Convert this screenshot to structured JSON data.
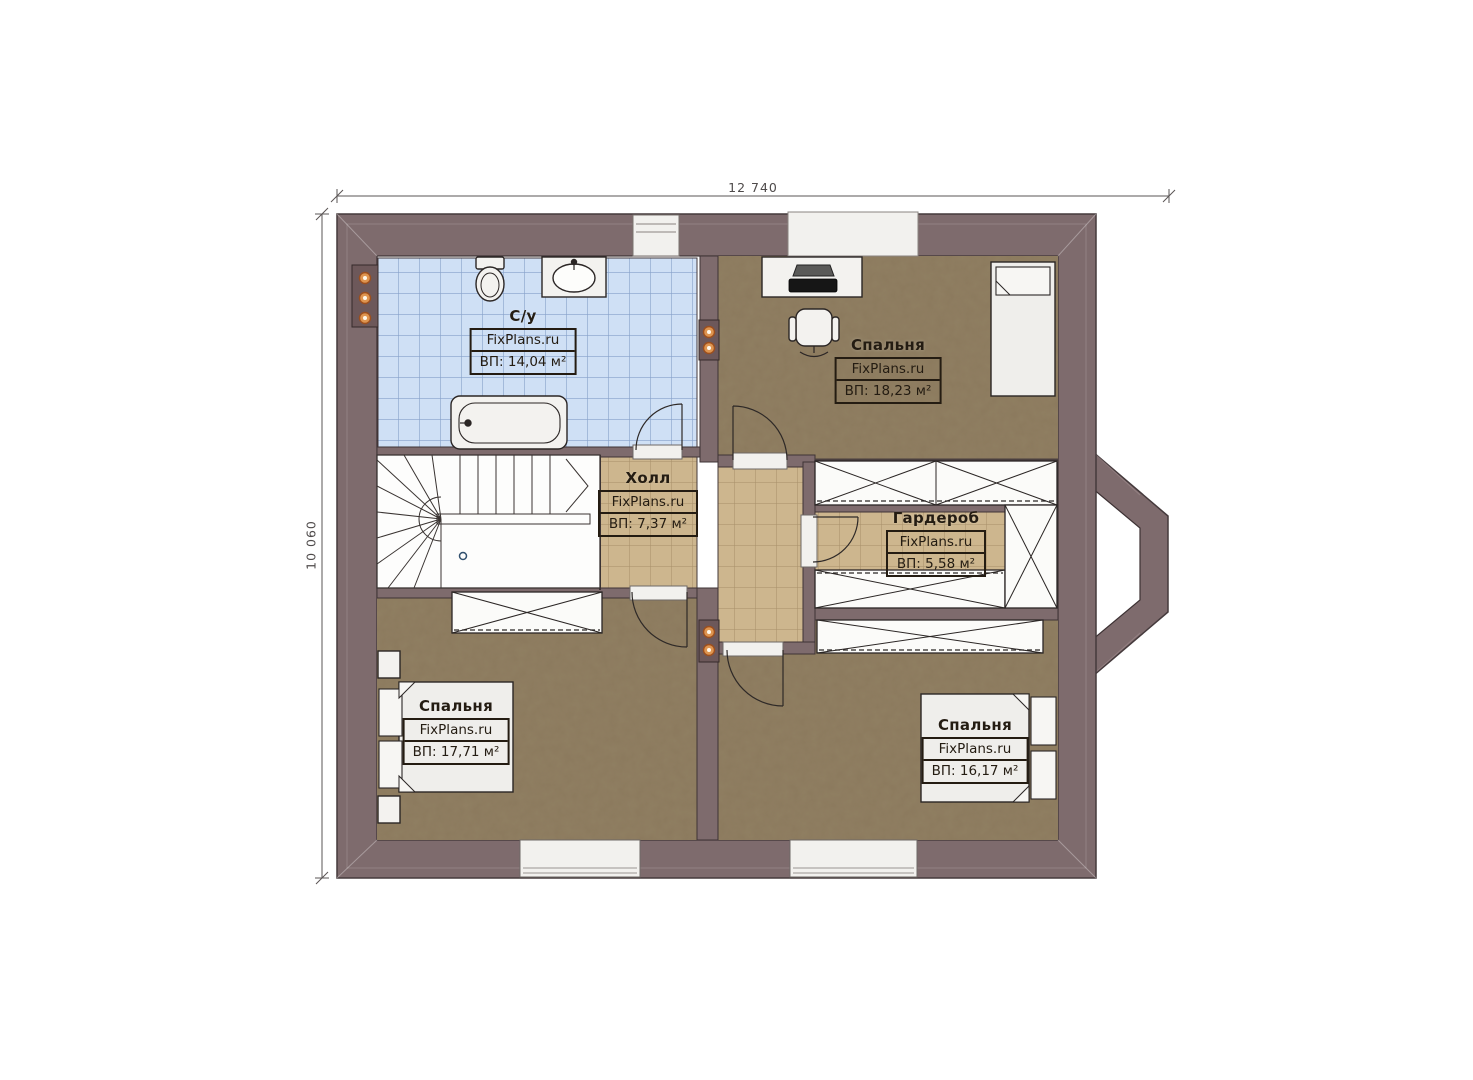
{
  "dimensions": {
    "width": "12 740",
    "height": "10 060"
  },
  "rooms": [
    {
      "key": "bathroom",
      "label": "С/у",
      "brand": "FixPlans.ru",
      "area": "ВП: 14,04 м²"
    },
    {
      "key": "bedroom_top_right",
      "label": "Спальня",
      "brand": "FixPlans.ru",
      "area": "ВП: 18,23 м²"
    },
    {
      "key": "hall",
      "label": "Холл",
      "brand": "FixPlans.ru",
      "area": "ВП: 7,37 м²"
    },
    {
      "key": "wardrobe",
      "label": "Гардероб",
      "brand": "FixPlans.ru",
      "area": "ВП: 5,58 м²"
    },
    {
      "key": "bedroom_bottom_left",
      "label": "Спальня",
      "brand": "FixPlans.ru",
      "area": "ВП: 17,71 м²"
    },
    {
      "key": "bedroom_bottom_right",
      "label": "Спальня",
      "brand": "FixPlans.ru",
      "area": "ВП: 16,17 м²"
    }
  ],
  "colors": {
    "background": "#ffffff",
    "wall": "#7e6b6d",
    "floor_wood": "#8b795d",
    "floor_tile_hall": "#cdb68e",
    "floor_tile_bath": "#cfe0f5",
    "furniture": "#f3f2ef",
    "accent_dot": "#df9550",
    "dimension_text": "#4f4b4b"
  }
}
